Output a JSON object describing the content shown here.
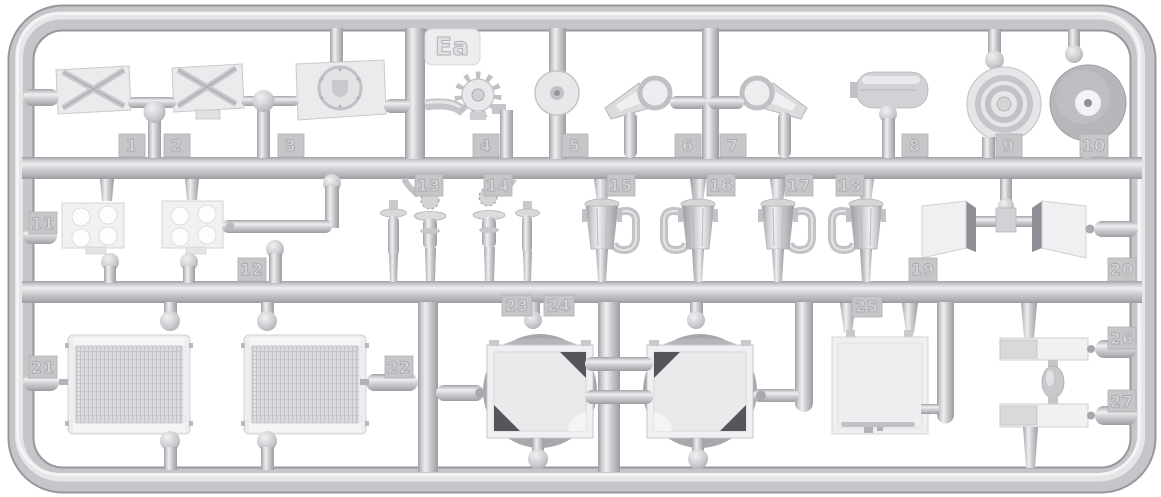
{
  "sprue": {
    "code": "Ea",
    "description": "injection-molded model kit sprue (runner frame) with numbered parts, light gray plastic on white background",
    "colors": {
      "background": "#ffffff",
      "plastic": "#c7c7cb",
      "plastic_highlight": "#ebebee",
      "plastic_shadow": "#9fa0a5",
      "part_face": "#f0f0f2",
      "dark_accent": "#55555c",
      "tag_face": "#c6c6c9",
      "mesh": "#d9d9dc"
    },
    "parts": [
      {
        "number": "1",
        "shape": "x-braced hatch plate"
      },
      {
        "number": "2",
        "shape": "x-braced hatch plate with tab"
      },
      {
        "number": "3",
        "shape": "hull plate with round hatch"
      },
      {
        "number": "4",
        "shape": "toothed hub"
      },
      {
        "number": "5",
        "shape": "small disc with hub"
      },
      {
        "number": "6",
        "shape": "axle bracket with ring"
      },
      {
        "number": "7",
        "shape": "axle bracket with ring, mirrored"
      },
      {
        "number": "8",
        "shape": "cylindrical canister"
      },
      {
        "number": "9",
        "shape": "concentric-ring wheel hub"
      },
      {
        "number": "10",
        "shape": "domed wheel hub"
      },
      {
        "number": "11",
        "shape": "four-hole mounting plate"
      },
      {
        "number": "12",
        "shape": "four-hole mounting plate with bent pipe"
      },
      {
        "number": "13",
        "shape": "valve assembly"
      },
      {
        "number": "14",
        "shape": "valve assembly, mirrored"
      },
      {
        "number": "15",
        "shape": "funnel body with curved pipe"
      },
      {
        "number": "16",
        "shape": "funnel body with curved pipe, mirrored"
      },
      {
        "number": "17",
        "shape": "funnel body with curved pipe"
      },
      {
        "number": "18",
        "shape": "funnel body with curved pipe, mirrored"
      },
      {
        "number": "19",
        "shape": "angled stowage box pair, left"
      },
      {
        "number": "20",
        "shape": "angled stowage box pair, right"
      },
      {
        "number": "21",
        "shape": "radiator core with mesh"
      },
      {
        "number": "22",
        "shape": "radiator core with mesh"
      },
      {
        "number": "23",
        "shape": "round tank half in square frame"
      },
      {
        "number": "24",
        "shape": "round tank half in square frame"
      },
      {
        "number": "25",
        "shape": "access panel with handle bar"
      },
      {
        "number": "26",
        "shape": "flat bracket bar"
      },
      {
        "number": "27",
        "shape": "flat bracket bar"
      }
    ]
  }
}
